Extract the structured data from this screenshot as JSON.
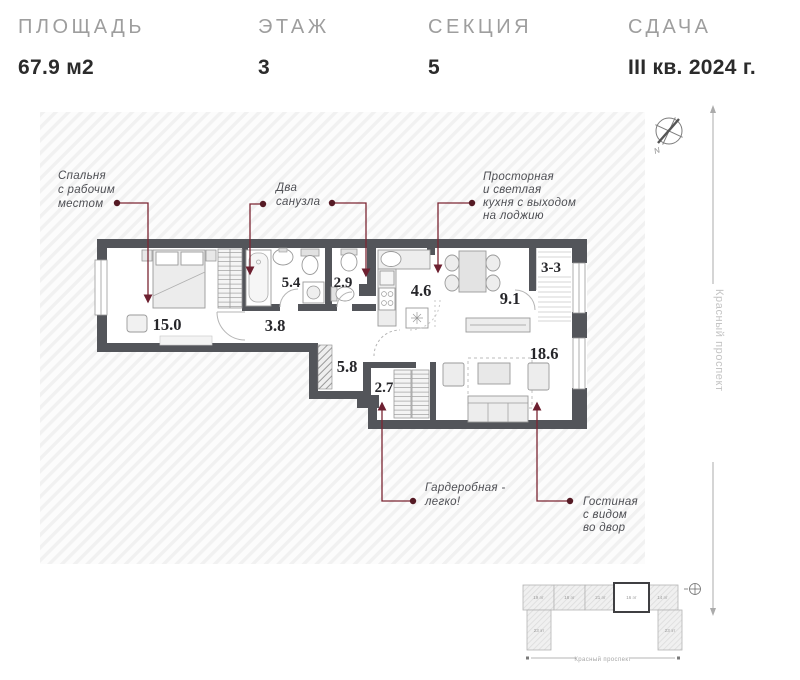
{
  "header": {
    "specs": [
      {
        "label": "ПЛОЩАДЬ",
        "value": "67.9 м2"
      },
      {
        "label": "ЭТАЖ",
        "value": "3"
      },
      {
        "label": "СЕКЦИЯ",
        "value": "5"
      },
      {
        "label": "СДАЧА",
        "value": "III кв. 2024 г."
      }
    ]
  },
  "plan": {
    "rooms": {
      "bedroom": "15.0",
      "hall": "3.8",
      "bath_large": "5.4",
      "bath_small": "2.9",
      "corridor": "5.8",
      "wardrobe": "2.7",
      "kitchen": "4.6",
      "dining": "9.1",
      "loggia": "3-3",
      "living": "18.6"
    },
    "callouts": {
      "bedroom": {
        "line1": "Спальня",
        "line2": "с рабочим",
        "line3": "местом"
      },
      "bathrooms": {
        "line1": "Два",
        "line2": "санузла"
      },
      "kitchen": {
        "line1": "Просторная",
        "line2": "и светлая",
        "line3": "кухня с выходом",
        "line4": "на лоджию"
      },
      "wardrobe": {
        "line1": "Гардеробная -",
        "line2": "легко!"
      },
      "living": {
        "line1": "Гостиная",
        "line2": "с видом",
        "line3": "во двор"
      }
    },
    "compass_label": "N",
    "street_label": "Красный проспект"
  },
  "minimap": {
    "sections": [
      {
        "label": "19 эт"
      },
      {
        "label": "18 эт"
      },
      {
        "label": "21 эт"
      },
      {
        "label": "16 эт"
      },
      {
        "label": "14 эт"
      }
    ],
    "wings": [
      {
        "label": "23 эт"
      },
      {
        "label": "23 эт"
      }
    ],
    "street_label": "Красный проспект"
  },
  "colors": {
    "wall": "#53555a",
    "leader": "#7b2532",
    "accent_dot": "#551a24"
  }
}
